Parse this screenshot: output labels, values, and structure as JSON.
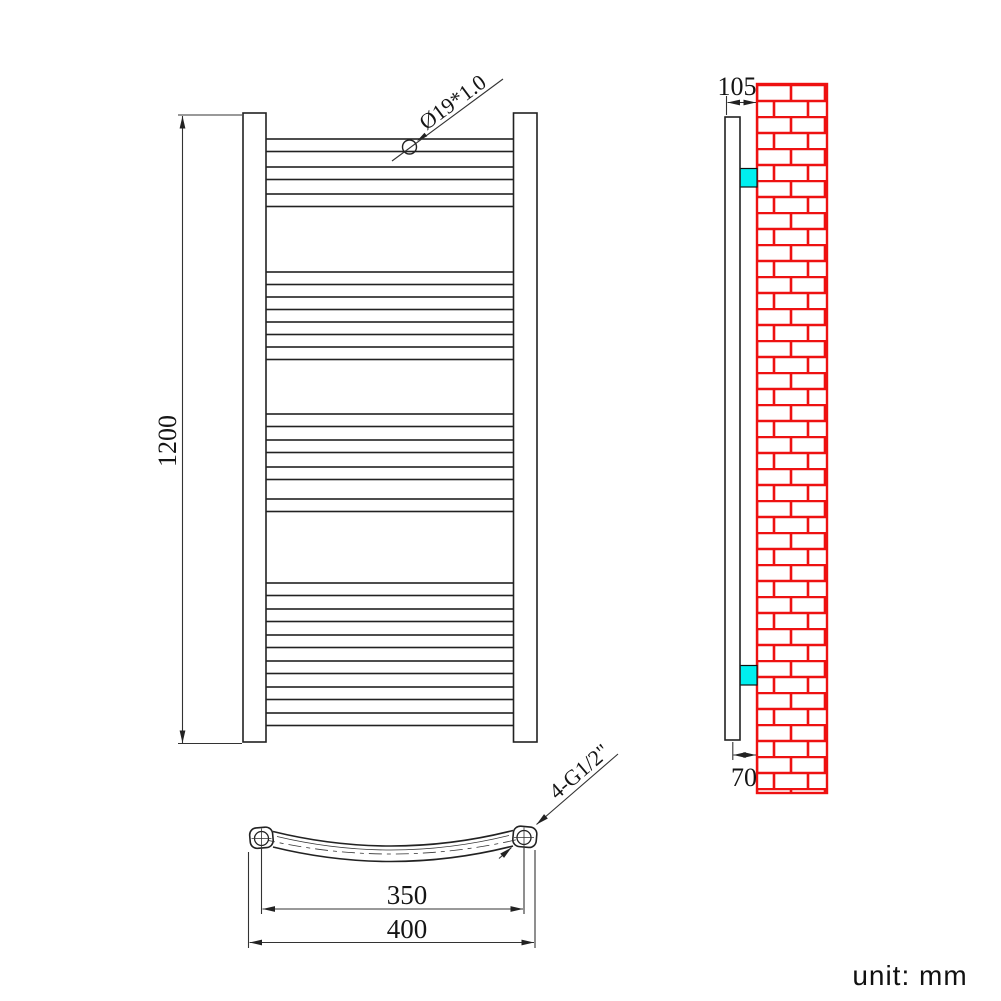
{
  "drawing": {
    "unit_label": "unit: mm",
    "dimensions": {
      "height": "1200",
      "tube_diameter": "Ø19*1.0",
      "wall_offset_top": "105",
      "wall_offset_bottom": "70",
      "centers_width": "350",
      "overall_width": "400",
      "fitting": "4-G1/2\""
    },
    "colors": {
      "line": "#222222",
      "brick_red": "#ee1111",
      "bracket_cyan": "#00efef",
      "background": "#ffffff"
    },
    "front_view": {
      "bars_x": 265,
      "bars_width": 249,
      "bar_height": 12.5,
      "bar_groups": [
        {
          "tops": [
            139,
            167,
            194
          ]
        },
        {
          "tops": [
            272,
            297,
            322,
            347
          ]
        },
        {
          "tops": [
            414,
            440,
            467,
            499
          ]
        },
        {
          "tops": [
            583,
            609,
            635,
            661,
            687,
            713
          ]
        }
      ]
    }
  }
}
